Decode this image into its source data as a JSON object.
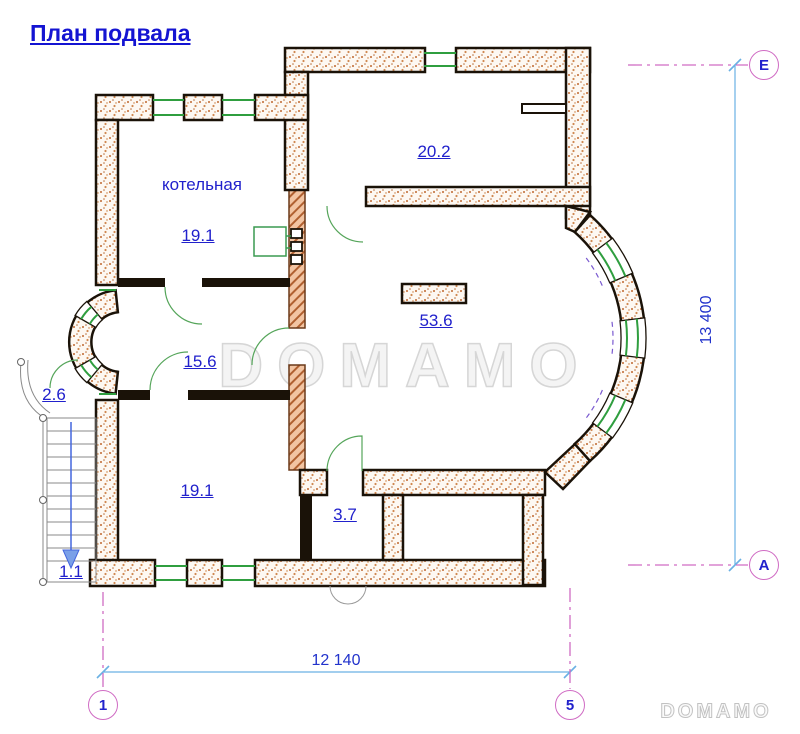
{
  "title": "План подвала",
  "watermark_text": "DOMAMO",
  "logo_text": "DOMAMO",
  "labels": {
    "boiler_room_name": "котельная",
    "boiler_room_area": "19.1",
    "top_room_area": "20.2",
    "main_room_area": "53.6",
    "corridor_area": "15.6",
    "porch_area": "2.6",
    "bottom_room_area": "19.1",
    "small_room_area": "3.7",
    "stair_area": "1.1"
  },
  "dimensions": {
    "total_height": "13 400",
    "total_width": "12 140"
  },
  "axis_markers": {
    "top_right": "Е",
    "bottom_right": "А",
    "bottom_left": "1",
    "bottom_mid": "5"
  },
  "colors": {
    "title_blue": "#1414d2",
    "label_blue": "#2121cc",
    "dimension_blue": "#6ab0e4",
    "axis_magenta": "#d06cc4",
    "wall_edge_black": "#1a1208",
    "wall_speckle_orange": "#c06830",
    "hatch_salmon": "#e8a87e",
    "window_green": "#2f9e3f",
    "door_green": "#55a55a",
    "stair_gray": "#8a8a8a",
    "arrow_blue": "#4466dd",
    "watermark_gray": "#d6d6d6"
  }
}
